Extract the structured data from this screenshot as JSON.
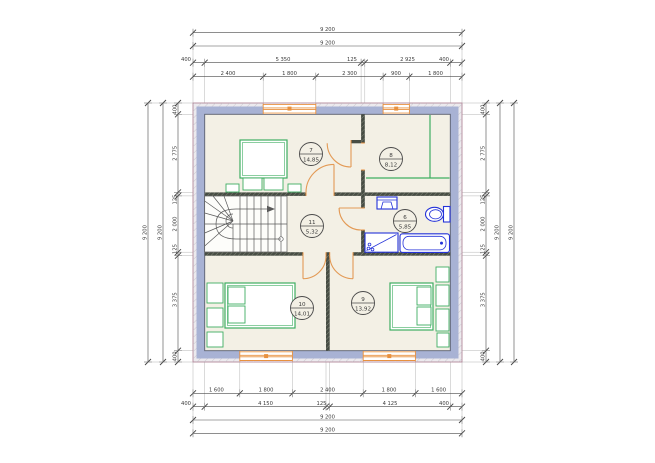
{
  "drawing": {
    "type": "floor-plan",
    "floor": "attic / second floor",
    "units": "mm"
  },
  "colors": {
    "exterior_wall": "#a8b2d4",
    "interior_wall": "#474d44",
    "floor": "#f3f0e5",
    "hatch_band": "#eceaee",
    "outer_line": "#b2889a",
    "door_window_orange": "#e8913f",
    "furniture_green": "#3fae62",
    "fixture_blue": "#2432d9",
    "dim_line": "#4a4a4a"
  },
  "rooms": {
    "r7": {
      "number": "7",
      "area": "14,85"
    },
    "r8": {
      "number": "8",
      "area": "8,12"
    },
    "r11": {
      "number": "11",
      "area": "5,32"
    },
    "r6": {
      "number": "6",
      "area": "5,85"
    },
    "r10": {
      "number": "10",
      "area": "14,01"
    },
    "r9": {
      "number": "9",
      "area": "13,92"
    }
  },
  "dims": {
    "top": {
      "totals": [
        "9 200",
        "9 200"
      ],
      "row3": [
        "400",
        "5 350",
        "125",
        "2 925",
        "400"
      ],
      "row4": [
        "2 400",
        "1 800",
        "2 300",
        "900",
        "1 800"
      ]
    },
    "bottom": {
      "row1": [
        "1 600",
        "1 800",
        "2 400",
        "1 800",
        "1 600"
      ],
      "row2": [
        "400",
        "4 150",
        "125",
        "4 125",
        "400"
      ],
      "totals": [
        "9 200",
        "9 200"
      ]
    },
    "left": {
      "row": [
        "400",
        "2 775",
        "125",
        "2 000",
        "125",
        "3 375",
        "400"
      ],
      "totals": [
        "9 200",
        "9 200"
      ]
    },
    "right": {
      "row": [
        "400",
        "2 775",
        "125",
        "2 000",
        "125",
        "3 375",
        "400"
      ],
      "totals": [
        "9 200",
        "9 200"
      ]
    }
  }
}
